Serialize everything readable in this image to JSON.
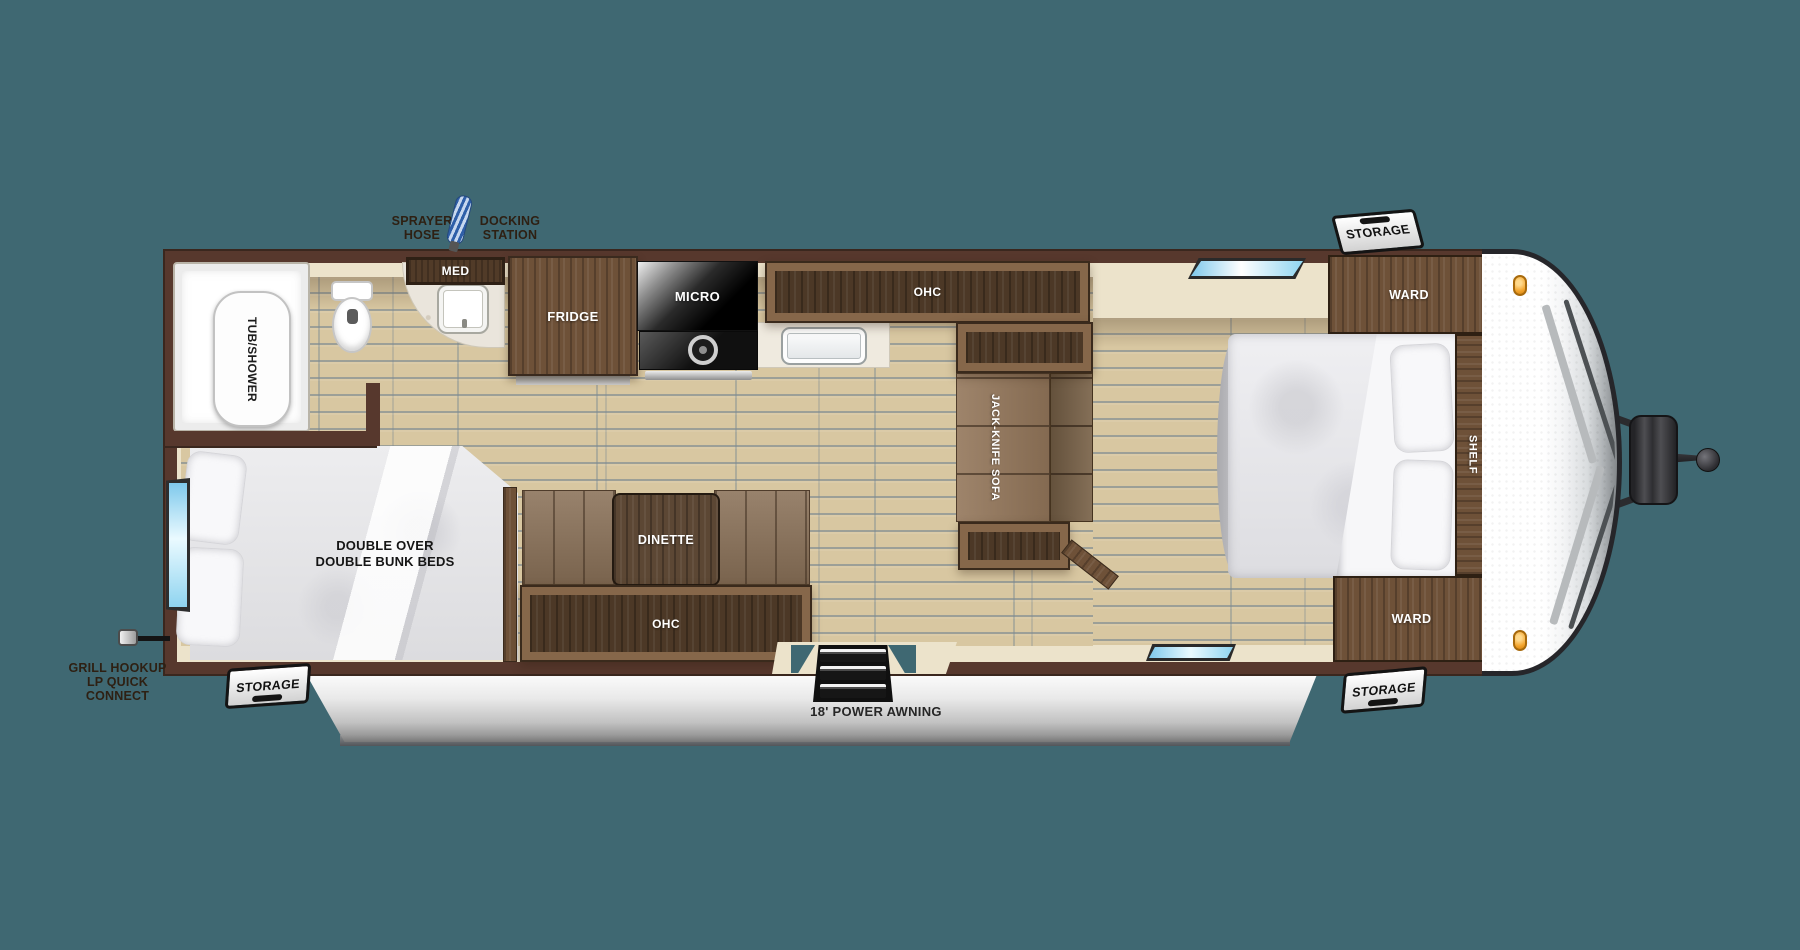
{
  "title": "Travel trailer floor plan",
  "colors": {
    "background": "#3F6872",
    "wall": "#57382d",
    "interior_trim": "#ece3cb",
    "floor_plank": "#d8c7a1",
    "cabinet_wood": "#6e5138",
    "window_blue": "#8fd4f0",
    "awning_silver": "#c2c2c2",
    "marker_light_orange": "#f2a32b"
  },
  "bathroom": {
    "tub_label": "TUB/SHOWER",
    "med_label": "MED"
  },
  "kitchen": {
    "fridge_label": "FRIDGE",
    "micro_label": "MICRO",
    "ohc_label": "OHC"
  },
  "living": {
    "sofa_label": "JACK-KNIFE SOFA",
    "dinette_label": "DINETTE",
    "ohc_label": "OHC"
  },
  "bunk_room": {
    "label_line1": "DOUBLE OVER",
    "label_line2": "DOUBLE BUNK BEDS"
  },
  "bedroom": {
    "ward_top_label": "WARD",
    "shelf_label": "SHELF",
    "ward_bottom_label": "WARD"
  },
  "exterior": {
    "awning_label": "18' POWER AWNING",
    "storage_top_label": "STORAGE",
    "storage_bottom_right_label": "STORAGE",
    "storage_bottom_left_label": "STORAGE",
    "sprayer_line1": "SPRAYER",
    "sprayer_line2": "HOSE",
    "docking_line1": "DOCKING",
    "docking_line2": "STATION",
    "grill_line1": "GRILL HOOKUP",
    "grill_line2": "LP QUICK CONNECT"
  }
}
